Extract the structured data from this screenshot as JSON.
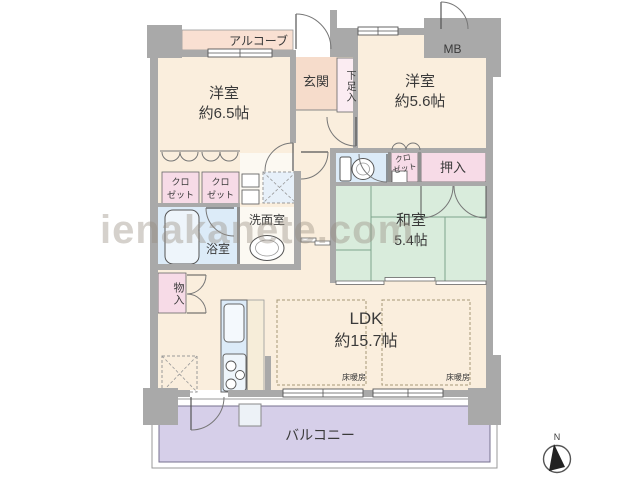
{
  "watermark": "ienakanete.com",
  "labels": {
    "alcove": "アルコーブ",
    "entrance": "玄関",
    "shoe_cabinet": "下足入",
    "western_room_1_name": "洋室",
    "western_room_1_size": "約6.5帖",
    "western_room_2_name": "洋室",
    "western_room_2_size": "約5.6帖",
    "meter_box": "MB",
    "closet_line1": "クロ",
    "closet_line2": "ゼット",
    "oshiire": "押入",
    "japanese_room_name": "和室",
    "japanese_room_size": "5.4帖",
    "washroom": "洗面室",
    "bathroom": "浴室",
    "storage": "物入",
    "ldk_name": "LDK",
    "ldk_size": "約15.7帖",
    "floor_heating": "床暖房",
    "balcony": "バルコニー",
    "compass_north": "N"
  },
  "colors": {
    "room_cream": "#faeedd",
    "entrance_pink": "#f6dccb",
    "alcove_pink": "#f9e0d2",
    "closet_pink": "#f7dbe7",
    "wet_area_blue": "#dcebf8",
    "tatami_green": "#d9ecdc",
    "balcony_purple": "#d6cfe9",
    "wall_gray": "#a9a9a9"
  }
}
